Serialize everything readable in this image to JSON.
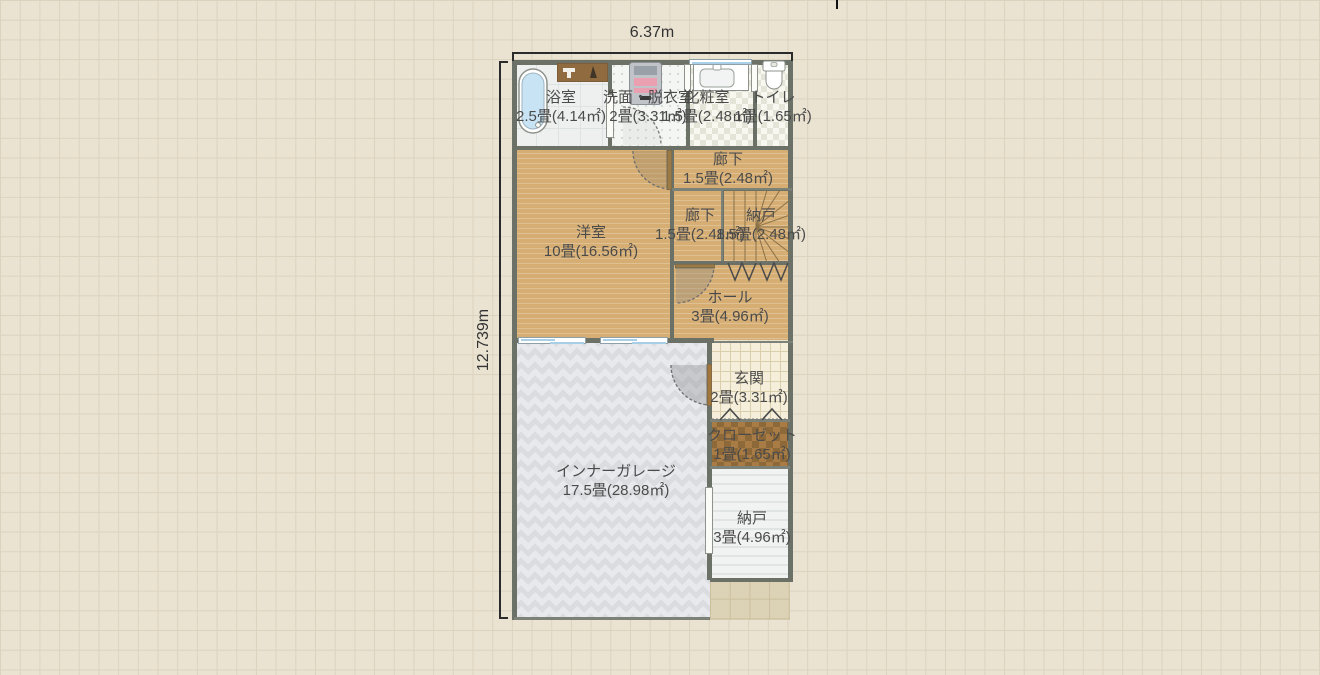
{
  "app": {
    "view": "floor-plan-editor-canvas",
    "grid_background": "#eae3d2"
  },
  "dimensions": {
    "width": "6.37m",
    "height": "12.739m"
  },
  "rooms": [
    {
      "id": "bathroom",
      "name": "浴室",
      "area": "2.5畳(4.14㎡)"
    },
    {
      "id": "washroom",
      "name": "洗面・脱衣室",
      "area": "2畳(3.31㎡)"
    },
    {
      "id": "powder-room",
      "name": "化粧室",
      "area": "1.5畳(2.48㎡)"
    },
    {
      "id": "toilet",
      "name": "トイレ",
      "area": "1畳(1.65㎡)"
    },
    {
      "id": "western-room",
      "name": "洋室",
      "area": "10畳(16.56㎡)"
    },
    {
      "id": "corridor-upper",
      "name": "廊下",
      "area": "1.5畳(2.48㎡)"
    },
    {
      "id": "corridor-lower",
      "name": "廊下",
      "area": "1.5畳(2.48㎡)"
    },
    {
      "id": "storage-stairs",
      "name": "納戸",
      "area": "1.5畳(2.48㎡)"
    },
    {
      "id": "hall",
      "name": "ホール",
      "area": "3畳(4.96㎡)"
    },
    {
      "id": "entrance",
      "name": "玄関",
      "area": "2畳(3.31㎡)"
    },
    {
      "id": "closet",
      "name": "クローゼット",
      "area": "1畳(1.65㎡)"
    },
    {
      "id": "storage-lower",
      "name": "納戸",
      "area": "3畳(4.96㎡)"
    },
    {
      "id": "inner-garage",
      "name": "インナーガレージ",
      "area": "17.5畳(28.98㎡)"
    }
  ],
  "icons": [
    "bathtub-icon",
    "bath-counter-icon",
    "vanity-icon",
    "washbasin-icon",
    "toilet-icon",
    "stairs-icon",
    "swing-door-icon",
    "bifold-door-icon",
    "sliding-door-icon",
    "window-icon"
  ],
  "colors": {
    "wood_floor": "#d6ae74",
    "wall": "#6b7166",
    "garage_floor": "#e7e9ec",
    "closet_floor": "#a87c44",
    "entrance_tile": "#f4eedb",
    "window_glass": "#a9cfe6",
    "label_text": "#4b4b4b",
    "dimension_line": "#2b2b2b"
  }
}
